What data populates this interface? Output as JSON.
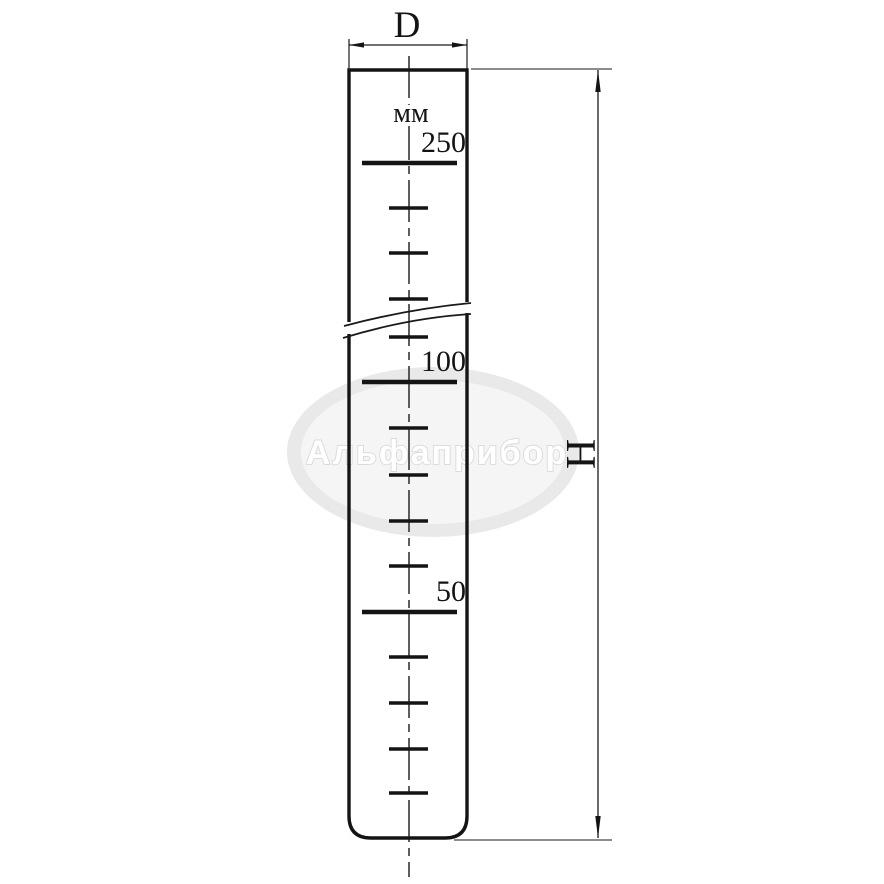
{
  "drawing": {
    "dimension_labels": {
      "diameter": "D",
      "height": "H"
    },
    "scale": {
      "unit": "мм",
      "major_marks": [
        {
          "label": "250",
          "y": 163
        },
        {
          "label": "100",
          "y": 382
        },
        {
          "label": "50",
          "y": 612
        }
      ],
      "minor_mark_ys": [
        208,
        253,
        299,
        337,
        428,
        475,
        521,
        566,
        657,
        703,
        749,
        793
      ],
      "major_line_x1": 362,
      "major_line_x2": 457,
      "minor_line_x1": 389,
      "minor_line_x2": 428,
      "label_right_x": 466
    }
  },
  "watermark": {
    "text": "Альфаприбор"
  },
  "colors": {
    "line": "#141414",
    "background": "#ffffff",
    "watermark_ring": "#e9e9e9",
    "watermark_inner": "#f5f5f5",
    "watermark_text_fill": "#ffffff",
    "watermark_text_outline": "#dcdcdc"
  }
}
